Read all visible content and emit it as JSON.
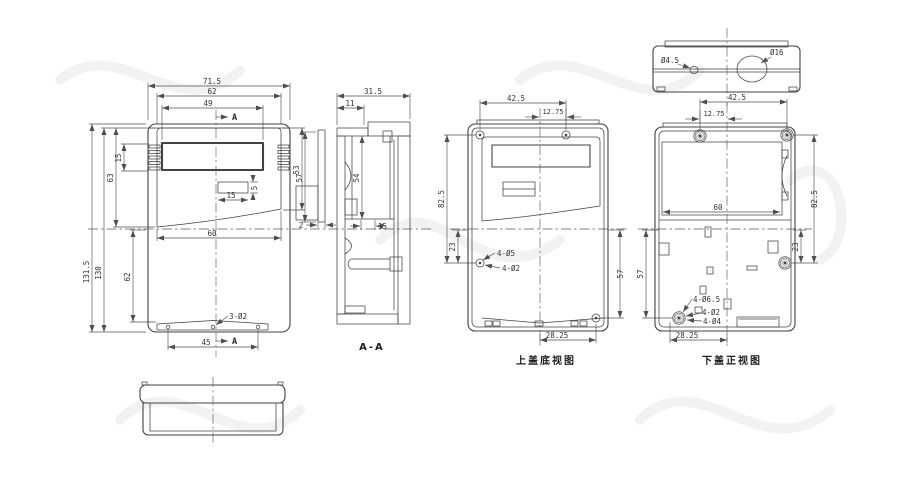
{
  "front_view": {
    "dim_total_width": "71.5",
    "dim_lid_width": "62",
    "dim_window_width": "49",
    "section_marker": "A",
    "dim_vent_height": "15",
    "dim_lid_height_left": "63",
    "dim_body_height": "130",
    "dim_total_height": "131.5",
    "dim_lid_height_right": "53",
    "dim_button_width": "15",
    "dim_button_height": "5",
    "dim_mid_width": "60",
    "dim_lower_height": "62",
    "label_bottom_holes": "3-Ø2",
    "dim_hole_span": "45"
  },
  "front_panel_section": {
    "dim_height": "57",
    "dim_thickness": "2"
  },
  "section_aa": {
    "label": "A-A",
    "dim_depth": "31.5",
    "dim_lid_depth": "11",
    "dim_cavity_height": "54",
    "dim_step": "15"
  },
  "top_cover_bottom_view": {
    "label": "上盖底视图",
    "dim_screw_span_x": "42.5",
    "dim_screw_offset": "12.75",
    "dim_screw_span_y": "82.5",
    "dim_mid_screw_offset": "23",
    "dim_lower_screw_y": "57",
    "dim_lower_screw_x": "28.25",
    "label_screw_holes": "4-Ø5",
    "label_pilot_holes": "4-Ø2"
  },
  "bottom_cover_front_view": {
    "label": "下盖正视图",
    "dim_screw_span_x": "42.5",
    "dim_screw_offset": "12.75",
    "dim_screw_span_y": "82.5",
    "dim_mid_screw_offset": "23",
    "dim_lower_screw_y": "57",
    "dim_compartment_width": "60",
    "dim_lower_screw_x": "28.25",
    "label_boss_holes": "4-Ø6.5",
    "label_pilot_holes": "4-Ø2",
    "label_screw_holes": "4-Ø4"
  },
  "top_view": {
    "label_small_hole": "Ø4.5",
    "label_large_hole": "Ø16"
  }
}
